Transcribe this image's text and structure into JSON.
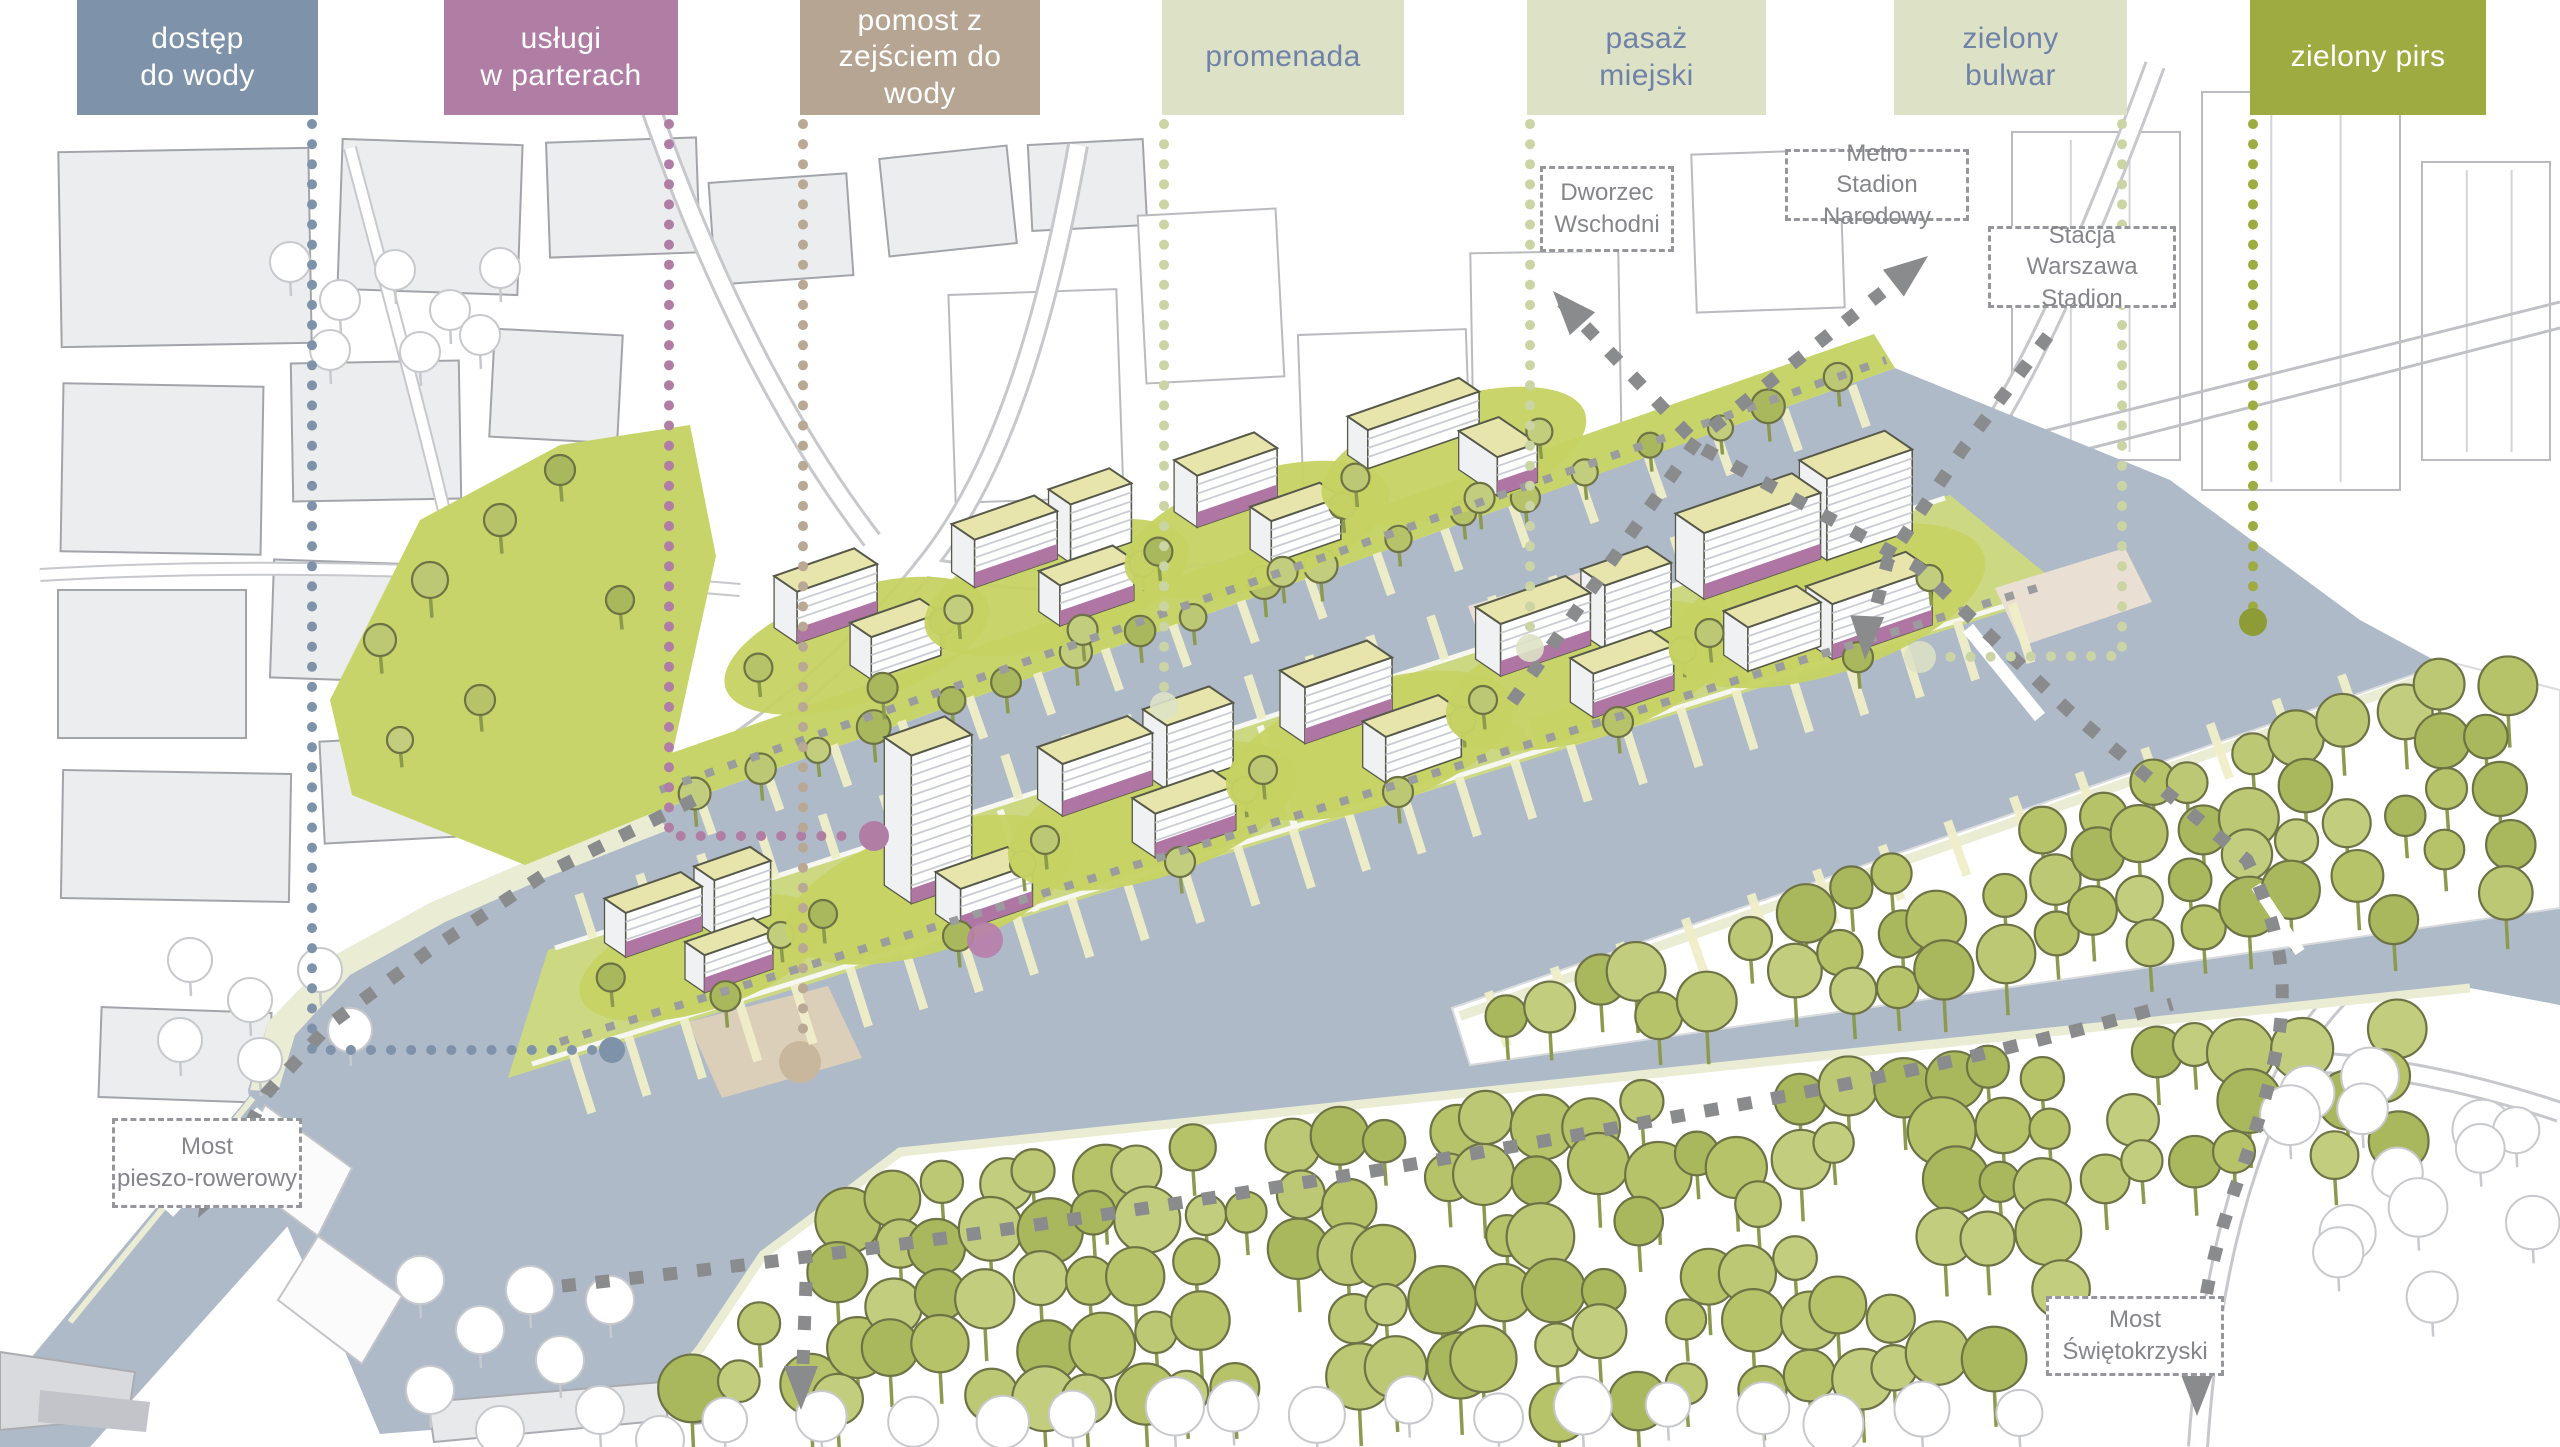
{
  "legend": {
    "items": [
      {
        "id": "dostep-do-wody",
        "label": "dostęp\ndo wody",
        "color": "#7E93A9",
        "text_color": "#FFFFFF"
      },
      {
        "id": "uslugi-w-parterach",
        "label": "usługi\nw parterach",
        "color": "#B07EA4",
        "text_color": "#FFFFFF"
      },
      {
        "id": "pomost-z-zejsciem-do-wody",
        "label": "pomost z\nzejściem do\nwody",
        "color": "#B5A592",
        "text_color": "#FFFFFF"
      },
      {
        "id": "promenada",
        "label": "promenada",
        "color": "#DDE2C6",
        "text_color": "#6F82A8"
      },
      {
        "id": "pasaz-miejski",
        "label": "pasaż\nmiejski",
        "color": "#DDE2C6",
        "text_color": "#6F82A8"
      },
      {
        "id": "zielony-bulwar",
        "label": "zielony\nbulwar",
        "color": "#DDE2C6",
        "text_color": "#6F82A8"
      },
      {
        "id": "zielony-pirs",
        "label": "zielony pirs",
        "color": "#9EAB40",
        "text_color": "#FFFFFF"
      }
    ]
  },
  "map_labels": {
    "dworzec_wschodni": "Dworzec\nWschodni",
    "metro_stadion_narodowy": "Metro\nStadion Narodowy",
    "stacja_warszawa_stadion": "Stacja Warszawa\nStadion",
    "most_pieszo_rowerowy": "Most\npieszo-rowerowy",
    "most_swietokrzyski": "Most\nŚwiętokrzyski"
  },
  "palette": {
    "water": "#AFBAC8",
    "lawn_green": "#C7D46A",
    "tree_green": "#B7C369",
    "roof_yellow": "#E7E4AC",
    "service_purple": "#AF76A4",
    "pier_tan": "#DCCFBA",
    "route_gray": "#8A8B8D",
    "context_gray": "#ECEDEF"
  }
}
